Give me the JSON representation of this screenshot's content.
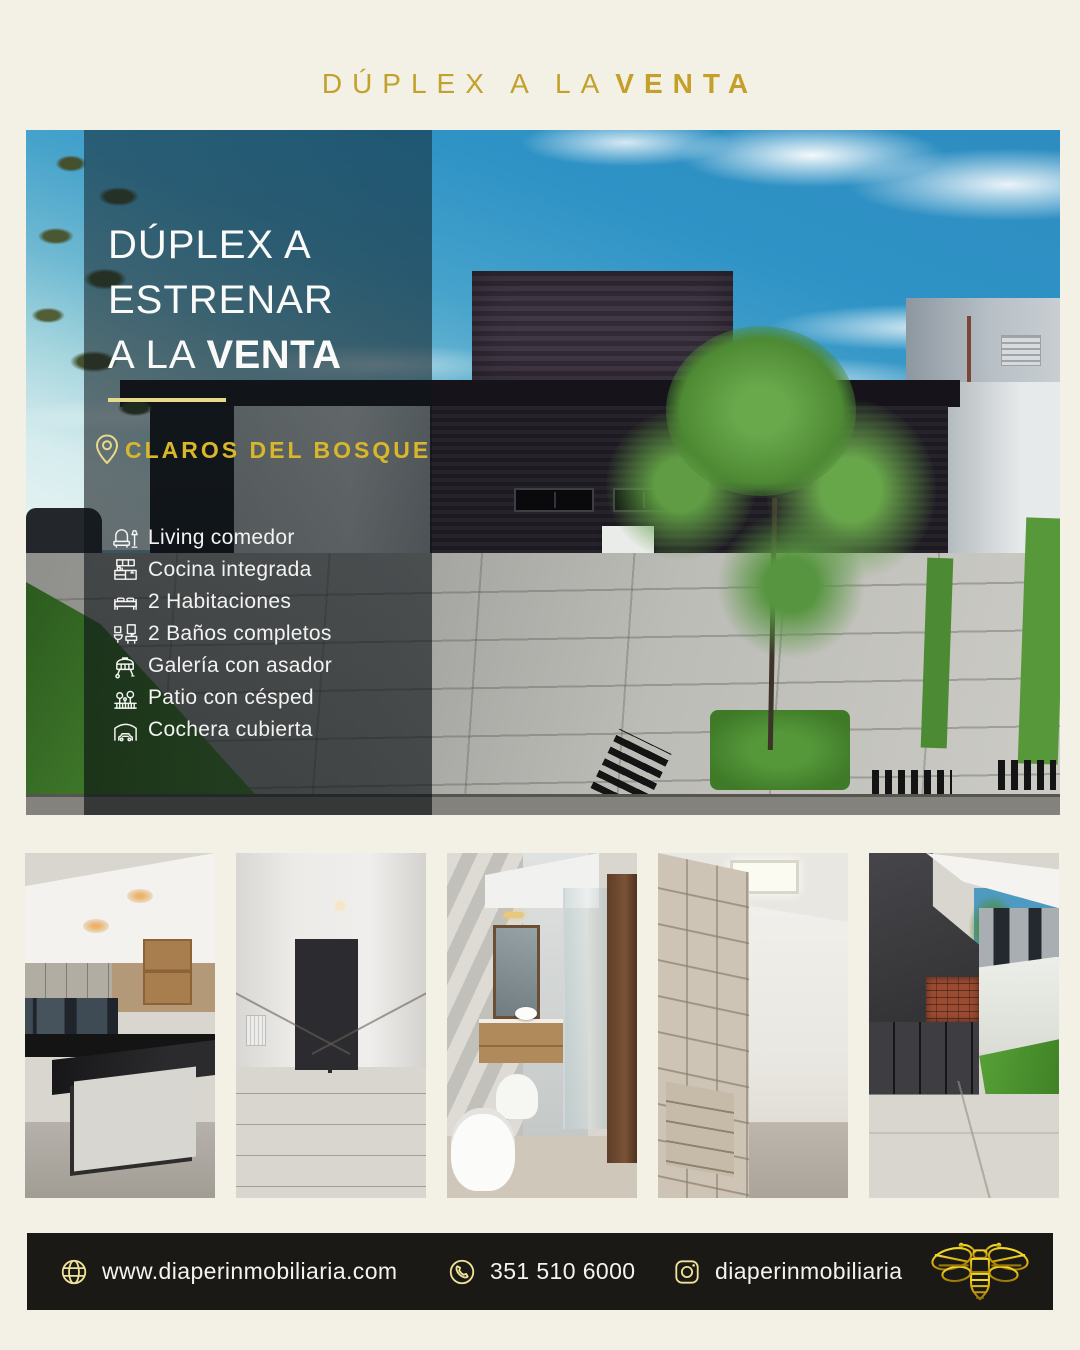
{
  "header": {
    "title": "DÚPLEX A LA",
    "title_bold": "VENTA"
  },
  "hero": {
    "title_line1": "DÚPLEX A",
    "title_line2": "ESTRENAR",
    "title_line3": "A LA",
    "title_line3_bold": "VENTA",
    "location_label": "CLAROS DEL BOSQUE",
    "features": [
      {
        "icon": "sofa-lamp-icon",
        "label": "Living comedor"
      },
      {
        "icon": "kitchen-cabinet-icon",
        "label": "Cocina integrada"
      },
      {
        "icon": "bed-icon",
        "label": "2 Habitaciones"
      },
      {
        "icon": "bathroom-icon",
        "label": "2 Baños completos"
      },
      {
        "icon": "grill-icon",
        "label": "Galería con asador"
      },
      {
        "icon": "garden-fence-icon",
        "label": "Patio con césped"
      },
      {
        "icon": "car-garage-icon",
        "label": "Cochera cubierta"
      }
    ]
  },
  "gallery": {
    "items": [
      {
        "name": "kitchen-photo"
      },
      {
        "name": "living-room-photo"
      },
      {
        "name": "bathroom-photo"
      },
      {
        "name": "walk-in-closet-photo"
      },
      {
        "name": "patio-grill-photo"
      }
    ]
  },
  "footer": {
    "website": "www.diaperinmobiliaria.com",
    "phone": "351 510 6000",
    "instagram": "diaperinmobiliaria"
  },
  "colors": {
    "background": "#f3f0e5",
    "gold": "#c2a12d",
    "gold_bright": "#d8b82a",
    "gold_pale": "#e9d98c",
    "footer_background": "#1a1916",
    "overlay_tint": "rgba(12,19,24,0.58)"
  }
}
